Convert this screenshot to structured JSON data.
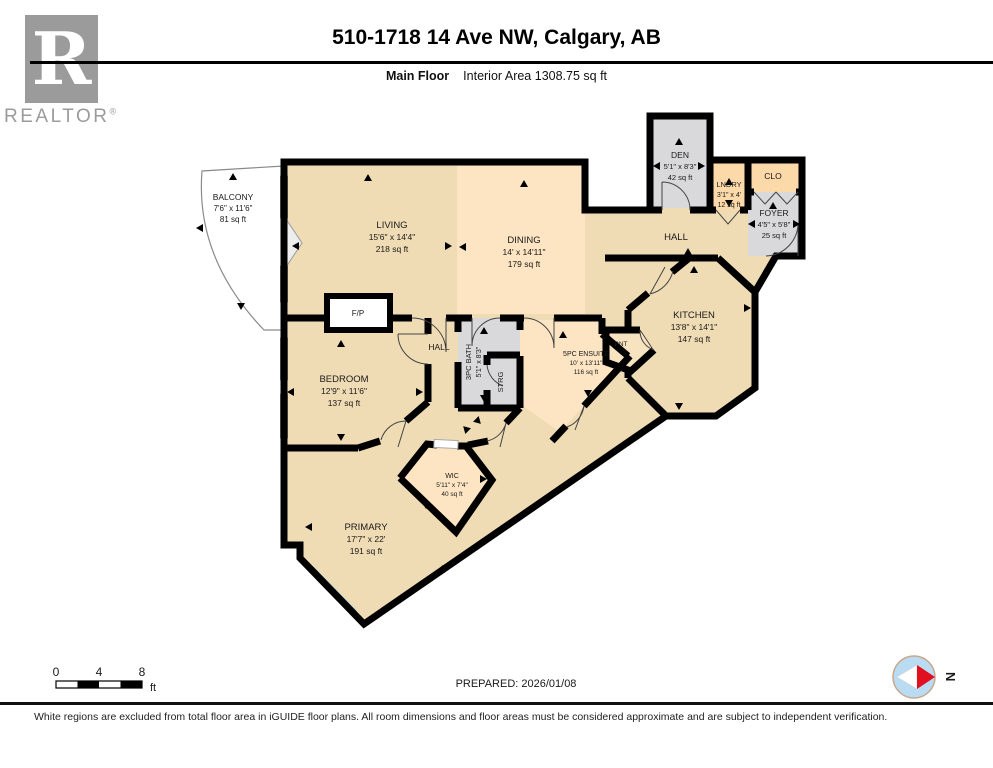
{
  "header": {
    "logo_letter": "R",
    "logo_text": "REALTOR",
    "logo_reg": "®",
    "title": "510-1718 14 Ave NW, Calgary, AB",
    "floor_label": "Main Floor",
    "area_label": "Interior Area 1308.75 sq ft"
  },
  "rooms": {
    "balcony": {
      "name": "BALCONY",
      "dims": "7'6\" x 11'6\"",
      "area": "81 sq ft"
    },
    "living": {
      "name": "LIVING",
      "dims": "15'6\" x 14'4\"",
      "area": "218 sq ft"
    },
    "dining": {
      "name": "DINING",
      "dims": "14' x 14'11\"",
      "area": "179 sq ft"
    },
    "den": {
      "name": "DEN",
      "dims": "5'1\" x 8'3\"",
      "area": "42 sq ft"
    },
    "lndry": {
      "name": "LNDRY",
      "dims": "3'1\" x 4'",
      "area": "12 sq ft"
    },
    "clo": {
      "name": "CLO"
    },
    "foyer": {
      "name": "FOYER",
      "dims": "4'5\" x 5'8\"",
      "area": "25 sq ft"
    },
    "hall": {
      "name": "HALL"
    },
    "hall2": {
      "name": "HALL"
    },
    "kitchen": {
      "name": "KITCHEN",
      "dims": "13'8\" x 14'1\"",
      "area": "147 sq ft"
    },
    "fp": {
      "name": "F/P"
    },
    "bedroom": {
      "name": "BEDROOM",
      "dims": "12'9\" x 11'6\"",
      "area": "137 sq ft"
    },
    "bath": {
      "name": "3PC BATH",
      "dims": "5'1\" x 8'3\""
    },
    "strg": {
      "name": "STRG"
    },
    "ensuite": {
      "name": "5PC ENSUITE",
      "dims": "10' x 13'11\"",
      "area": "116 sq ft"
    },
    "pnt": {
      "name": "PNT"
    },
    "wic": {
      "name": "WIC",
      "dims": "5'11\" x 7'4\"",
      "area": "40 sq ft"
    },
    "primary": {
      "name": "PRIMARY",
      "dims": "17'7\" x 22'",
      "area": "191 sq ft"
    }
  },
  "scale_bar": {
    "tick_0": "0",
    "tick_4": "4",
    "tick_8": "8",
    "unit": "ft"
  },
  "prepared": "PREPARED: 2026/01/08",
  "compass": {
    "label": "N"
  },
  "footer": "White regions are excluded from total floor area in iGUIDE floor plans. All room dimensions and floor areas must be considered approximate and are subject to independent verification.",
  "colors": {
    "room_tan": "#f0dcb4",
    "room_peach": "#fde5c3",
    "room_gray": "#d9d9dc",
    "room_orange": "#fbd9a9",
    "window_blue": "#7fc3e8",
    "wall": "#000000",
    "compass_red": "#e01020"
  }
}
